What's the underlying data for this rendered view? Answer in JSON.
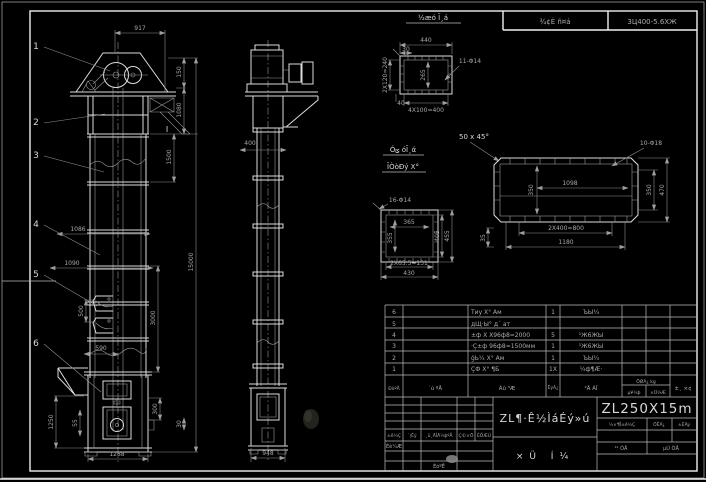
{
  "header": {
    "label": "¾¢Ė ñ¤á",
    "drawing_no": "3Ц400-5.6ХЖ"
  },
  "balloons": {
    "b1": "1",
    "b2": "2",
    "b3": "3",
    "b4": "4",
    "b5": "5",
    "b6": "6"
  },
  "front": {
    "d917": "917",
    "d150": "150",
    "d1080": "1080",
    "d1500": "1500",
    "d15000": "15000",
    "d3000": "3000",
    "d1086": "1086",
    "d1090": "1090",
    "d500": "500",
    "d590": "590",
    "d1288": "1288",
    "d1250": "1250",
    "d55": "55",
    "d300": "300",
    "d30": "30",
    "section_mark": "I"
  },
  "side": {
    "d400": "400",
    "d948": "948"
  },
  "sec_top": {
    "title": "½æó Ī¸á",
    "d440": "440",
    "d30": "30",
    "d240": "2X120=240",
    "d40": "40",
    "d265": "265",
    "holes": "11-Φ14",
    "d400": "4X100=400"
  },
  "sec_mid": {
    "holes": "16-Φ14",
    "cap1": "Óݶ óĪ¸ά",
    "cap2": "ĪÒòĐý Х°",
    "d365": "365",
    "d355": "355",
    "d405": "405",
    "d455": "455",
    "d131": "2X65.5=131",
    "d430": "430"
  },
  "note_chamfer": "50 x 45°",
  "sec_right": {
    "holes": "10-Φ18",
    "d1098": "1098",
    "d350l": "350",
    "d350r": "350",
    "d470": "470",
    "d800": "2X400=800",
    "d1180": "1180",
    "d35": "35"
  },
  "bom": {
    "col_no": "ÐòºÅ",
    "col_code": "´ú ºÅ",
    "col_name": "Ãû ³Æ",
    "col_qty": "ÊýÁ¿",
    "col_mat": "²Ä ÁÏ",
    "col_wt": "ÖØÁ¿ kg",
    "col_unit": "µ¥¼þ",
    "col_total": "×Ü¼Æ",
    "col_note": "±¸ ×¢",
    "rows": [
      {
        "no": "6",
        "code": "",
        "name": "Тиу Х° Ам",
        "qty": "1",
        "mat": "ЪЫ¼"
      },
      {
        "no": "5",
        "code": "",
        "name": "дЩ·Ы° д´ ат",
        "qty": "",
        "mat": ""
      },
      {
        "no": "4",
        "code": "",
        "name": "±ф Х Х96ф8=2000",
        "qty": "5",
        "mat": "¹Ж6ЖЫ"
      },
      {
        "no": "3",
        "code": "",
        "name": "·Ç±ф 96ф8=1500мм",
        "qty": "1",
        "mat": "¹Ж6ЖЫ"
      },
      {
        "no": "2",
        "code": "",
        "name": "ģЬ¼ Х° Ам",
        "qty": "1",
        "mat": "ЪЫ¼"
      },
      {
        "no": "1",
        "code": "",
        "name": "ÇФ Х° ¶Б",
        "qty": "1X",
        "mat": "¼ф¶Æ·"
      }
    ]
  },
  "titleblock": {
    "rev_mark": "±ê¼Ç",
    "rev_count": "´¦Êý",
    "rev_doc": "¸ü¸ÄÎÄ¼þºÅ",
    "rev_sign": "Ç©×Ö",
    "rev_date": "ÈÕÆÚ",
    "design": "Éè¼Æ",
    "check": "ÉóºË",
    "title": "ZL¶·Ê½ÌáÉý»ú",
    "subtitle": "×Ü Í¼",
    "model": "ZL250X15m",
    "stage": "½×¶Î±ê¼Ç",
    "mass": "ÖÊÁ¿",
    "scale": "±ÈÀý",
    "sheets": "¹²  ÕÅ",
    "sheet_no": "µÚ  ÕÅ"
  }
}
